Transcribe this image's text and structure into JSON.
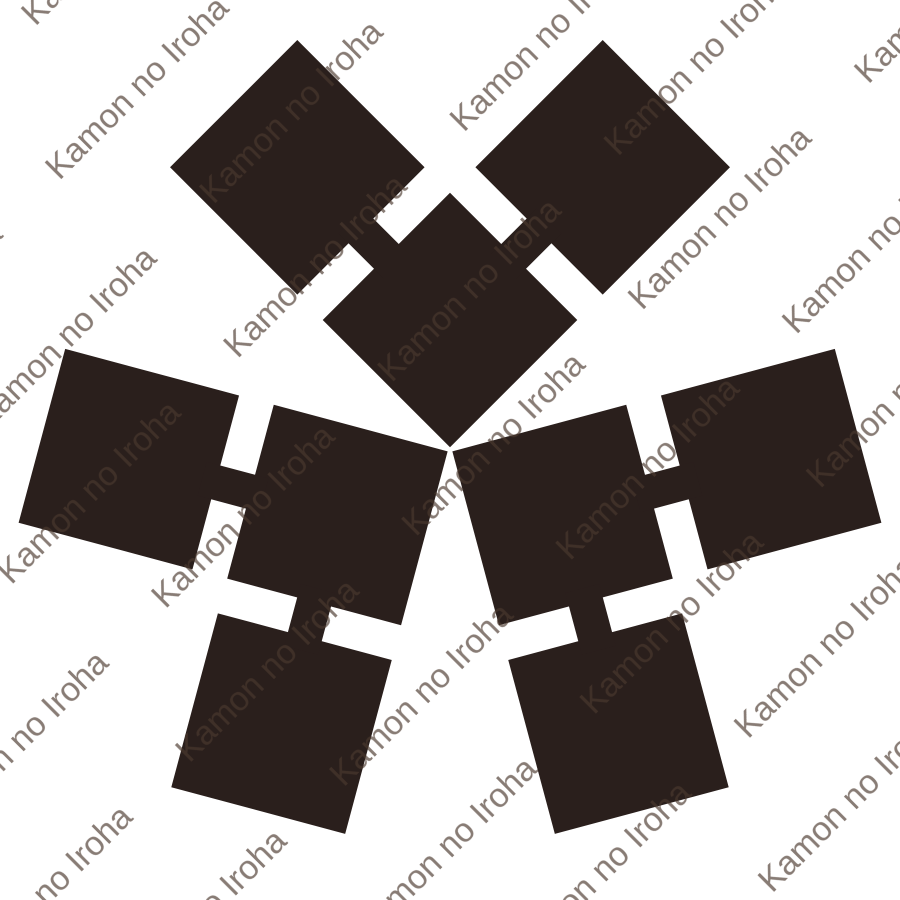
{
  "canvas": {
    "width": 900,
    "height": 900,
    "background": "#ffffff"
  },
  "watermark": {
    "text": "Kamon no Iroha",
    "color": "#4a382e",
    "opacity": 0.66,
    "font_size": 34,
    "angle_deg": -45,
    "tile_width": 320,
    "tile_height": 252,
    "row1_baseline": 44,
    "row2_baseline": 170,
    "row1_x": 6,
    "row2_x": -86,
    "row2_x_wrap": 234
  },
  "crest": {
    "ink": "#2a1f1c",
    "center_x": 450,
    "center_y": 450,
    "arm_rotations_deg": [
      0,
      -120,
      120
    ],
    "square_side": 180,
    "square_rotation_deg": 45,
    "arm_squares": [
      {
        "cx": 450,
        "cy": 320
      },
      {
        "cx": 297.3,
        "cy": 167.3
      },
      {
        "cx": 602.7,
        "cy": 167.3
      }
    ],
    "arm_necks": [
      {
        "cx": 373.6,
        "cy": 243.6,
        "length": 64,
        "width": 35,
        "angle_deg": 45
      },
      {
        "cx": 526.4,
        "cy": 243.6,
        "length": 64,
        "width": 35,
        "angle_deg": -45
      }
    ]
  }
}
